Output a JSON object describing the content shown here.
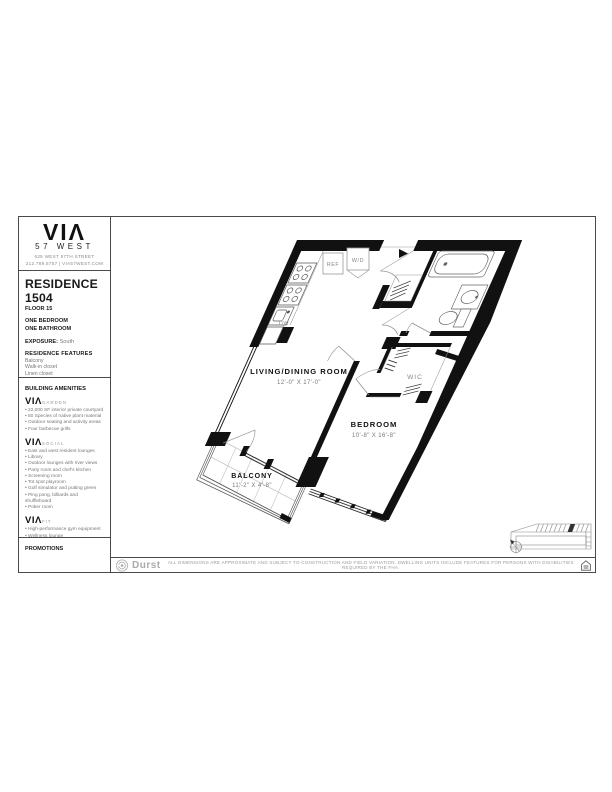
{
  "logo": {
    "brand": "VIΛ",
    "sub": "57 WEST",
    "address1": "625 WEST 57TH STREET",
    "address2": "212.789.5757 | VIA57WEST.COM"
  },
  "residence": {
    "title": "RESIDENCE 1504",
    "floor": "FLOOR 15",
    "config1": "ONE BEDROOM",
    "config2": "ONE BATHROOM",
    "exposure_label": "EXPOSURE:",
    "exposure_value": "South",
    "features_label": "RESIDENCE FEATURES",
    "features": [
      "Balcony",
      "Walk-in closet",
      "Linen closet",
      "Optional kitchen island",
      "Washer/Dryer"
    ],
    "rent_label": "MONTHLY RENT"
  },
  "amenities": {
    "label": "BUILDING AMENITIES",
    "groups": [
      {
        "brand": "VIΛ",
        "name": "GARDEN",
        "items": [
          "22,000 SF interior private courtyard",
          "50 Species of native plant material",
          "Outdoor seating and activity areas",
          "Four barbecue grills"
        ]
      },
      {
        "brand": "VIΛ",
        "name": "SOCIAL",
        "items": [
          "East and west resident lounges",
          "Library",
          "Outdoor lounges with river views",
          "Party room and chef's kitchen",
          "Screening room",
          "Tot spot playroom",
          "Golf simulator and putting green",
          "Ping pong, billiards and shuffleboard",
          "Poker room"
        ]
      },
      {
        "brand": "VIΛ",
        "name": "FIT",
        "items": [
          "High-performance gym equipment",
          "Wellness lounge",
          "Swimming pool and sun decks",
          "Exercise and spin studios",
          "Indoor half-court basketball"
        ]
      }
    ]
  },
  "promotions_label": "PROMOTIONS",
  "plan": {
    "living": {
      "name": "LIVING/DINING ROOM",
      "dim": "12'-0\" X 17'-0\""
    },
    "bedroom": {
      "name": "BEDROOM",
      "dim": "10'-8\" X 16'-8\""
    },
    "balcony": {
      "name": "BALCONY",
      "dim": "11'-2\" X 4'-8\""
    },
    "wic": "WIC",
    "ref": "REF",
    "wd": "W/D",
    "dw": "DW"
  },
  "footer": {
    "brand": "Durst",
    "disclaimer": "ALL DIMENSIONS ARE APPROXIMATE AND SUBJECT TO CONSTRUCTION AND FIELD VARIATION.  DWELLING UNITS INCLUDE FEATURES FOR PERSONS WITH DISABILITIES REQUIRED BY THE FHA."
  },
  "colors": {
    "wall": "#111111",
    "line_grey": "#999999",
    "text_grey": "#777777"
  }
}
